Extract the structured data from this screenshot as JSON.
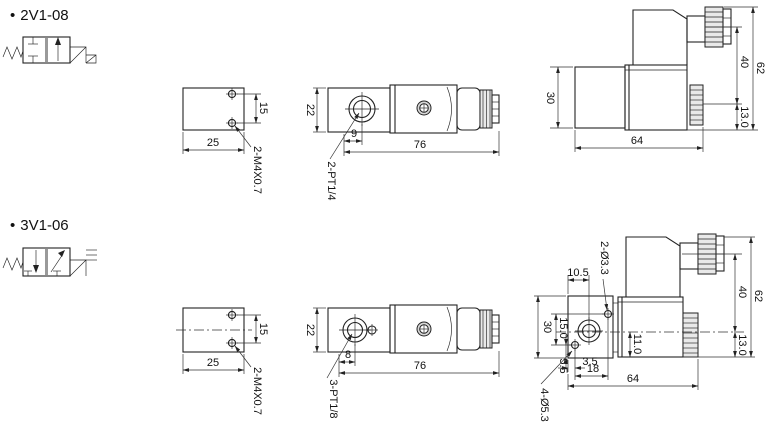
{
  "top": {
    "bullet": "•",
    "title": "2V1-08",
    "bracket": {
      "hole_spacing": "15",
      "width": "25",
      "thread_label": "2-M4X0.7"
    },
    "side": {
      "height": "22",
      "port_offset": "9",
      "length": "76",
      "port_label": "2-PT1/4"
    },
    "end": {
      "body_height": "30",
      "width": "64",
      "connector_height": "40",
      "total_height": "62",
      "nut_height": "13.0"
    }
  },
  "bottom": {
    "bullet": "•",
    "title": "3V1-06",
    "bracket": {
      "hole_spacing": "15",
      "width": "25",
      "thread_label": "2-M4X0.7"
    },
    "side": {
      "height": "22",
      "port_offset": "8",
      "length": "76",
      "port_label": "3-PT1/8"
    },
    "end": {
      "plate_hole_offset": "10.5",
      "top_holes_label": "2-Ø3.3",
      "body_height": "30",
      "hole_spacing_vertical": "15.0",
      "hole_edge_vertical": "5.5",
      "hole_edge_horizontal": "3.5",
      "hole_spacing_horizontal": "18",
      "width": "64",
      "port_center_depth": "11.0",
      "connector_height": "40",
      "total_height": "62",
      "nut_height": "13.0",
      "mount_holes_label": "4-Ø5.3"
    }
  }
}
